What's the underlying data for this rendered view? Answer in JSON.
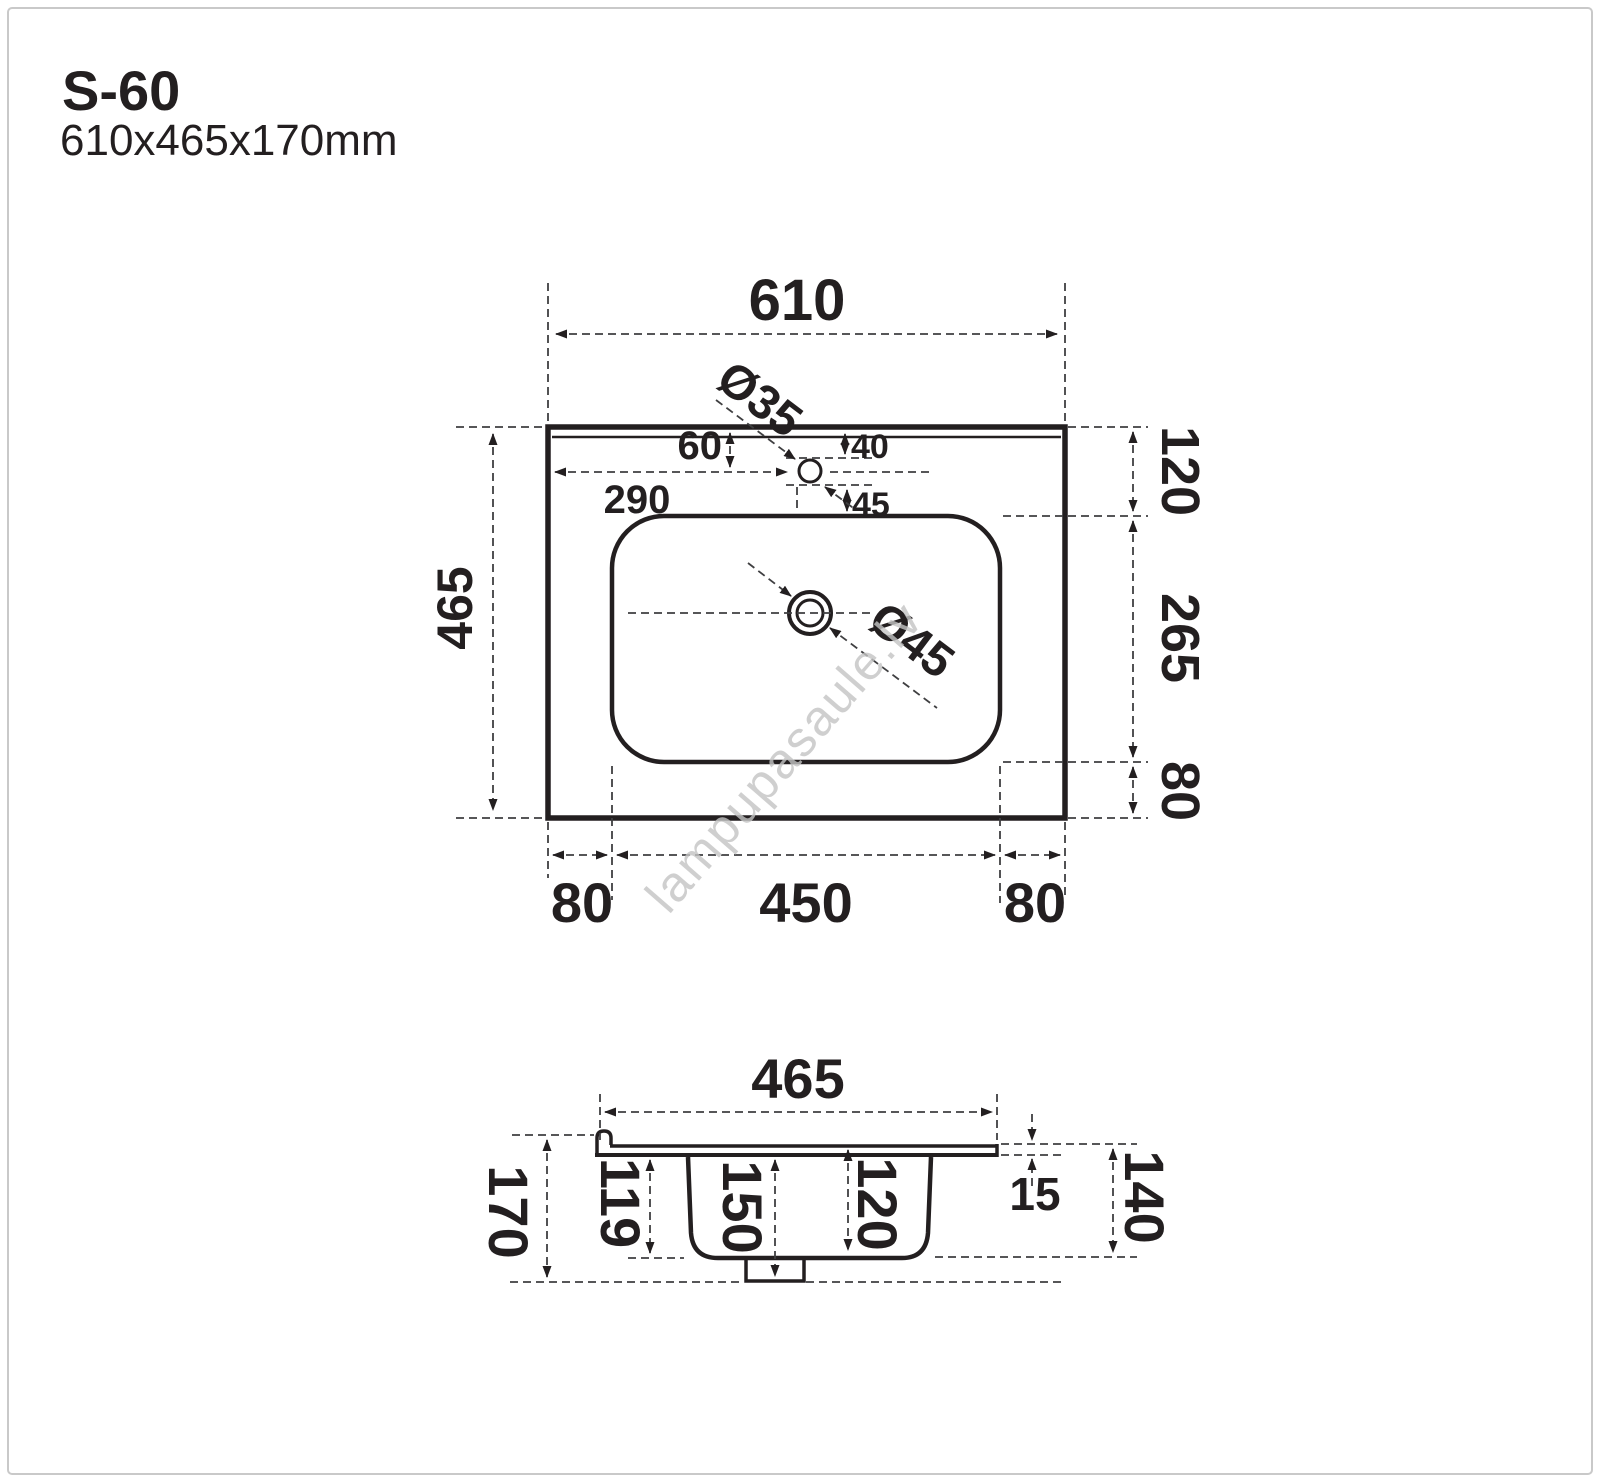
{
  "header": {
    "model": "S-60",
    "dimensions": "610x465x170mm"
  },
  "watermark": "lampupasaule.lv",
  "colors": {
    "line": "#231f20",
    "dimension_line": "#3f3f41",
    "watermark": "#c4c4c4",
    "frame": "#c9c9c9",
    "background": "#ffffff"
  },
  "top_view": {
    "overall_width": "610",
    "overall_depth": "465",
    "faucet_hole_diameter": "Ø35",
    "drain_diameter": "Ø45",
    "faucet_offset_from_top": "60",
    "faucet_offset_from_left": "290",
    "hole_clearance_top": "40",
    "hole_clearance_bottom": "45",
    "edge_to_basin_top": "120",
    "basin_depth_plan": "265",
    "basin_to_edge_bottom": "80",
    "bottom_margin_left": "80",
    "basin_width": "450",
    "bottom_margin_right": "80"
  },
  "side_view": {
    "overall_width": "465",
    "overall_height": "170",
    "bowl_inner_depth": "119",
    "drain_drop": "150",
    "bowl_depth": "120",
    "rim_thickness": "15",
    "bowl_outer_height": "140"
  }
}
